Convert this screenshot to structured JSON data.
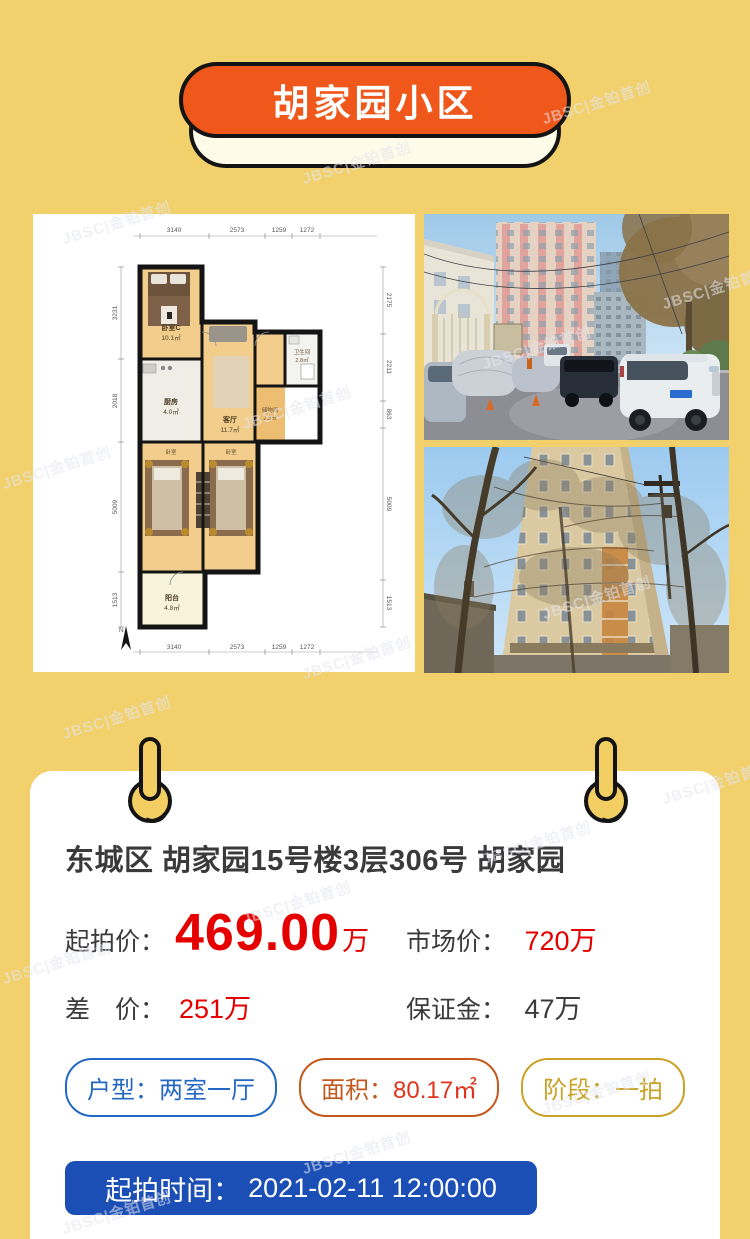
{
  "banner": {
    "title": "胡家园小区"
  },
  "watermark": {
    "text": "JBSC|金铂首创"
  },
  "floorplan": {
    "dims_top": [
      "3140",
      "2573",
      "1259",
      "1272"
    ],
    "dims_bottom": [
      "3140",
      "2573",
      "1259",
      "1272"
    ],
    "dims_left": [
      "3231",
      "2018",
      "5009",
      "1513"
    ],
    "dims_right": [
      "2175",
      "2211",
      "863",
      "5009",
      "1513"
    ],
    "rooms": {
      "bedroomC": {
        "name": "卧室C",
        "area": "10.1㎡"
      },
      "kitchen": {
        "name": "厨房",
        "area": "4.0㎡"
      },
      "living": {
        "name": "客厅",
        "area": "11.7㎡"
      },
      "bath": {
        "name": "卫生间",
        "area": "2.8㎡"
      },
      "storage": {
        "name": "储物间",
        "area": "2.3㎡"
      },
      "bedroomA": {
        "name": "卧室"
      },
      "bedroomB": {
        "name": "卧室"
      },
      "balcony": {
        "name": "阳台",
        "area": "4.8㎡"
      }
    },
    "compass": "N"
  },
  "listing": {
    "title": "东城区 胡家园15号楼3层306号 胡家园",
    "start_price": {
      "label": "起拍价：",
      "value": "469.00",
      "unit": "万"
    },
    "market_price": {
      "label": "市场价：",
      "value": "720万"
    },
    "diff_price": {
      "label": "差　价：",
      "value": "251万"
    },
    "deposit": {
      "label": "保证金：",
      "value": "47万"
    },
    "tags": {
      "layout": {
        "label": "户型：",
        "value": "两室一厅"
      },
      "area": {
        "label": "面积：",
        "value": "80.17㎡"
      },
      "stage": {
        "label": "阶段：",
        "value": "一拍"
      }
    },
    "start_time": {
      "label": "起拍时间：",
      "value": "2021-02-11 12:00:00"
    }
  },
  "colors": {
    "page_bg": "#f2d06c",
    "banner_orange": "#f0571a",
    "accent_red": "#e50000",
    "button_blue": "#1c4fb6",
    "tag_blue": "#2368c4",
    "tag_orange": "#c4571b",
    "tag_gold": "#c9a227"
  }
}
